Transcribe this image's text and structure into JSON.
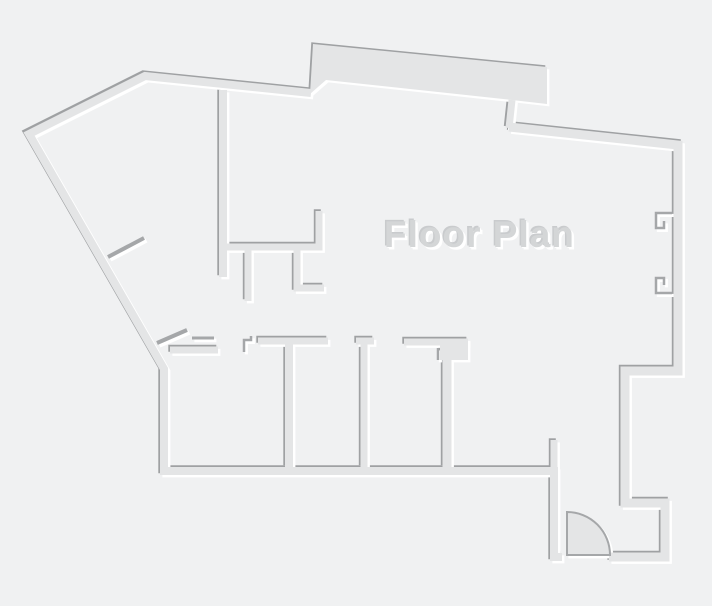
{
  "title": {
    "text": "Floor Plan"
  },
  "canvas": {
    "width": 712,
    "height": 606
  },
  "colors": {
    "background": "#f0f1f2",
    "wall_fill": "#e4e5e6",
    "shadow_dark": "#9fa1a3",
    "highlight_white": "#ffffff",
    "mark_dark": "#a5a7a9",
    "title_fill": "#d4d6d7",
    "title_highlight": "#ffffff",
    "title_shadow": "#c9cbcd"
  },
  "floorplan": {
    "width": 712,
    "height": 606,
    "effect": {
      "dark_dx": -1.7,
      "dark_dy": -1.7,
      "white_dx": 2.4,
      "white_dy": 2.4,
      "mark_white_extra_width": 0.6
    },
    "paths": [
      {
        "name": "outer-wall-left-and-bottom",
        "type": "wall",
        "w": 8,
        "d": "M311,93 L145,76 L29,134 L164,369 L164,471 L554,471 L554,557 L562,557"
      },
      {
        "name": "outer-wall-right",
        "type": "wall",
        "w": 9,
        "d": "M509,127 L678,145 L678,371 L625,371 L625,503 L665,503 L665,557 L609,557"
      },
      {
        "name": "step-wall-below-top-bump",
        "type": "wall",
        "w": 7,
        "d": "M512,100 L509,128"
      },
      {
        "name": "top-bump-thick-wall",
        "type": "fill",
        "d": "M310,94 L313,44 L547,67 L547,104 L512,100 L326,80 Z"
      },
      {
        "name": "stub-wall-above-bottom-wall-right-end",
        "type": "wall",
        "w": 7,
        "d": "M554,468 L554,440"
      },
      {
        "name": "interior-long-vertical-wall",
        "type": "wall",
        "w": 8,
        "d": "M223,90 L223,277"
      },
      {
        "name": "kitchen-l-wall",
        "type": "wall",
        "w": 7,
        "d": "M226,247 L319,247 L319,211"
      },
      {
        "name": "kitchen-stub-a",
        "type": "wall",
        "w": 7,
        "d": "M248,250 L248,301"
      },
      {
        "name": "kitchen-stub-b",
        "type": "wall",
        "w": 7,
        "d": "M297,250 L297,288 L324,288"
      },
      {
        "name": "room1-top-wall",
        "type": "wall",
        "w": 7,
        "d": "M170,350 L218,350"
      },
      {
        "name": "rooms-top-long-wall",
        "type": "wall",
        "w": 7,
        "d": "M258,341 L328,341"
      },
      {
        "name": "room-divider-1",
        "type": "wall",
        "w": 8,
        "d": "M289,344 L289,467"
      },
      {
        "name": "divider-2-jamb-bar",
        "type": "wall",
        "w": 7,
        "d": "M356,341 L374,341"
      },
      {
        "name": "room-divider-2",
        "type": "wall",
        "w": 7,
        "d": "M364,344 L364,467"
      },
      {
        "name": "divider-3-top-bar",
        "type": "wall",
        "w": 7,
        "d": "M404,342 L468,342"
      },
      {
        "name": "divider-3-corner-block",
        "type": "fill",
        "d": "M440,339 L468,339 L468,360 L440,360 Z"
      },
      {
        "name": "room-divider-3",
        "type": "wall",
        "w": 9,
        "d": "M447,356 L447,467"
      },
      {
        "name": "diagonal-door-jamb-upper",
        "type": "mark",
        "w": 4,
        "d": "M108,257 L144,238"
      },
      {
        "name": "diagonal-door-jamb-lower",
        "type": "mark",
        "w": 4,
        "d": "M157,343 L187,330"
      },
      {
        "name": "horizontal-jamb-stub",
        "type": "mark",
        "w": 3,
        "d": "M192,338 L214,338"
      },
      {
        "name": "door-step-glyph",
        "type": "mark",
        "w": 2.5,
        "d": "M244,352 L244,340 L251,340 L251,336"
      },
      {
        "name": "divider-3-jamb-tick",
        "type": "mark",
        "w": 2.5,
        "d": "M438,348 L438,360"
      },
      {
        "name": "right-wall-window-bracket-upper",
        "type": "mark",
        "w": 2.5,
        "d": "M672,213 L656,213 L656,228 L664,228 L664,221"
      },
      {
        "name": "right-wall-window-bracket-lower",
        "type": "mark",
        "w": 2.5,
        "d": "M672,293 L656,293 L656,278 L664,278 L664,285"
      },
      {
        "name": "entry-door-swing-arc",
        "type": "door",
        "w": 2,
        "d": "M567,512 A43,43 0 0 1 610,555 L567,555 Z"
      }
    ]
  }
}
